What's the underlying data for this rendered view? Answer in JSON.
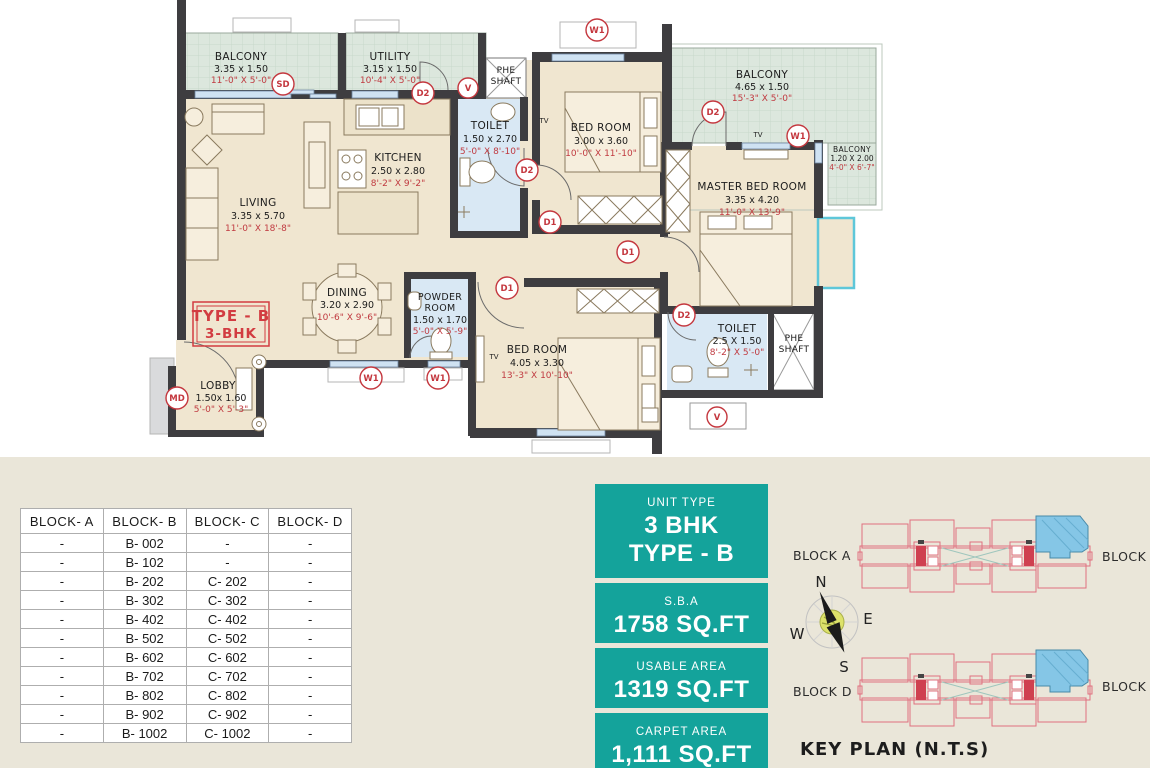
{
  "plan": {
    "type_box": {
      "line1": "TYPE - B",
      "line2": "3-BHK"
    },
    "rooms": {
      "balcony_tl": {
        "name": "BALCONY",
        "dim_m": "3.35 x 1.50",
        "dim_ft": "11'-0\" X 5'-0\""
      },
      "utility": {
        "name": "UTILITY",
        "dim_m": "3.15 x 1.50",
        "dim_ft": "10'-4\" X 5'-0\""
      },
      "phe_top": {
        "name_lines": [
          "PHE",
          "SHAFT"
        ]
      },
      "toilet_top": {
        "name": "TOILET",
        "dim_m": "1.50 x 2.70",
        "dim_ft": "5'-0\" X 8'-10\""
      },
      "kitchen": {
        "name": "KITCHEN",
        "dim_m": "2.50 x 2.80",
        "dim_ft": "8'-2\" X 9'-2\""
      },
      "living": {
        "name": "LIVING",
        "dim_m": "3.35 x 5.70",
        "dim_ft": "11'-0\" X 18'-8\""
      },
      "bedroom_top": {
        "name": "BED ROOM",
        "dim_m": "3.00 x 3.60",
        "dim_ft": "10'-0\" X 11'-10\""
      },
      "balcony_tr": {
        "name": "BALCONY",
        "dim_m": "4.65 x 1.50",
        "dim_ft": "15'-3\" X 5'-0\""
      },
      "balcony_r": {
        "name": "BALCONY",
        "dim_m": "1.20 X 2.00",
        "dim_ft": "4'-0\" X 6'-7\""
      },
      "master": {
        "name": "MASTER BED ROOM",
        "dim_m": "3.35 x 4.20",
        "dim_ft": "11'-0\" X 13'-9\""
      },
      "dining": {
        "name": "DINING",
        "dim_m": "3.20 x 2.90",
        "dim_ft": "10'-6\" X 9'-6\""
      },
      "powder": {
        "name_lines": [
          "POWDER",
          "ROOM"
        ],
        "dim_m": "1.50 x 1.70",
        "dim_ft": "5'-0\" X 5'-9\""
      },
      "bedroom_bot": {
        "name": "BED ROOM",
        "dim_m": "4.05 x 3.30",
        "dim_ft": "13'-3\" X 10'-10\""
      },
      "toilet_bot": {
        "name": "TOILET",
        "dim_m": "2.5 X 1.50",
        "dim_ft": "8'-2\" X 5'-0\""
      },
      "phe_bot": {
        "name_lines": [
          "PHE",
          "SHAFT"
        ]
      },
      "lobby": {
        "name": "LOBBY",
        "dim_m": "1.50x 1.60",
        "dim_ft": "5'-0\" X 5'-3\""
      }
    },
    "markers": {
      "sd": "SD",
      "v": "V",
      "w1": "W1",
      "d1": "D1",
      "d2": "D2",
      "md": "MD"
    },
    "tv": "TV"
  },
  "table": {
    "headers": [
      "BLOCK- A",
      "BLOCK- B",
      "BLOCK- C",
      "BLOCK- D"
    ],
    "rows": [
      [
        "-",
        "B- 002",
        "-",
        "-"
      ],
      [
        "-",
        "B- 102",
        "-",
        "-"
      ],
      [
        "-",
        "B- 202",
        "C- 202",
        "-"
      ],
      [
        "-",
        "B- 302",
        "C- 302",
        "-"
      ],
      [
        "-",
        "B- 402",
        "C- 402",
        "-"
      ],
      [
        "-",
        "B- 502",
        "C- 502",
        "-"
      ],
      [
        "-",
        "B- 602",
        "C- 602",
        "-"
      ],
      [
        "-",
        "B- 702",
        "C- 702",
        "-"
      ],
      [
        "-",
        "B- 802",
        "C- 802",
        "-"
      ],
      [
        "-",
        "B- 902",
        "C- 902",
        "-"
      ],
      [
        "-",
        "B- 1002",
        "C- 1002",
        "-"
      ]
    ]
  },
  "panels": [
    {
      "label": "UNIT TYPE",
      "value1": "3 BHK",
      "value2": "TYPE - B"
    },
    {
      "label": "S.B.A",
      "value1": "1758 SQ.FT"
    },
    {
      "label": "USABLE AREA",
      "value1": "1319 SQ.FT"
    },
    {
      "label": "CARPET AREA",
      "value1": "1,111 SQ.FT"
    }
  ],
  "keyplan": {
    "title": "KEY PLAN (N.T.S)",
    "blocks": {
      "a": "BLOCK A",
      "b": "BLOCK B",
      "c": "BLOCK C",
      "d": "BLOCK D"
    },
    "compass": {
      "n": "N",
      "e": "E",
      "w": "W",
      "s": "S"
    }
  },
  "colors": {
    "teal_panel": "#14a39b",
    "accent_red": "#c4373e",
    "wall": "#3e3d40",
    "floor_cream": "#f0e6d0",
    "balcony_green": "#dce7dd",
    "wet_blue": "#d9e8f4",
    "cyan_bay": "#5ec7d9",
    "keyplan_pink": "#e0707f",
    "keyplan_blue": "#85c6e6",
    "bottom_bg": "#eae6d9"
  }
}
